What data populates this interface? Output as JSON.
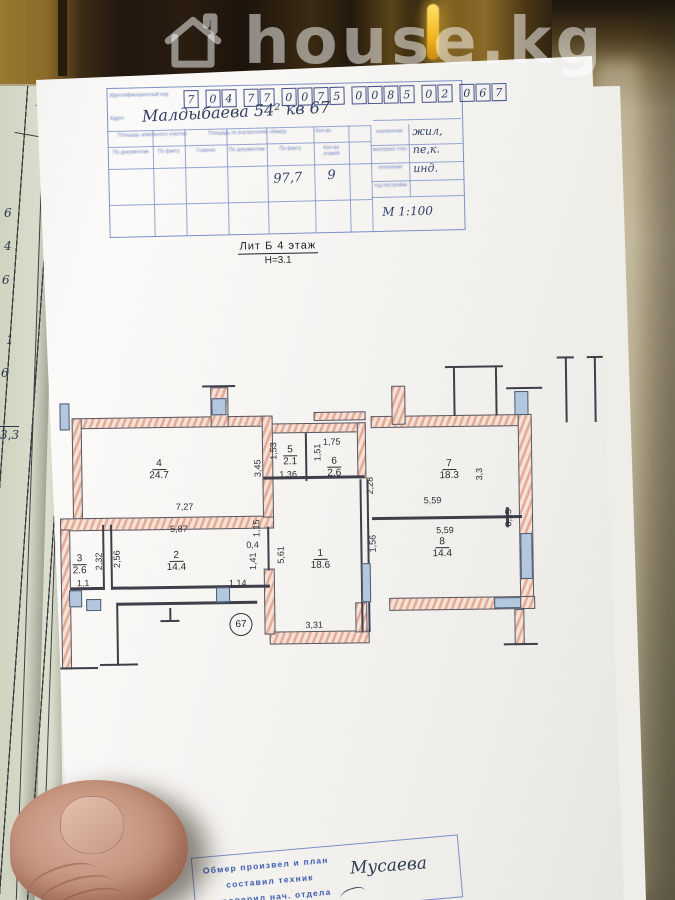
{
  "watermark": {
    "site_name": "house.kg"
  },
  "form": {
    "id_label": "Идентификационный код",
    "id_digits": [
      "7",
      "0",
      "4",
      "7",
      "7",
      "0",
      "0",
      "7",
      "5",
      "0",
      "0",
      "8",
      "5",
      "0",
      "2",
      "0",
      "6",
      "7"
    ],
    "address_label": "Адрес",
    "address_value": "Малдыбаева 54² кв 67",
    "table": {
      "section_headers": [
        "Площадь земельного участка",
        "Площадь по внутреннему обмеру",
        "Кол-во"
      ],
      "col_headers": [
        "По документам",
        "По факту",
        "Главная",
        "По документам",
        "По факту",
        "Кол-во этажей"
      ],
      "total_area_value": "97,7",
      "floors_value": "9",
      "right_rows": [
        {
          "label": "назначение",
          "value": "жил,"
        },
        {
          "label": "материал стен",
          "value": "пе,к."
        },
        {
          "label": "отопление",
          "value": "инд."
        },
        {
          "label": "год постройки",
          "value": ""
        }
      ],
      "scale_value": "М 1:100"
    }
  },
  "title": {
    "liter_floor": "Лит Б 4 этаж",
    "height": "Н=3.1"
  },
  "plan": {
    "apartment_number": "67",
    "rooms": [
      {
        "num": "1",
        "area": "18.6"
      },
      {
        "num": "2",
        "area": "14.4"
      },
      {
        "num": "3",
        "area": "2.6"
      },
      {
        "num": "4",
        "area": "24.7"
      },
      {
        "num": "5",
        "area": "2.1"
      },
      {
        "num": "6",
        "area": "2.6"
      },
      {
        "num": "7",
        "area": "18.3"
      },
      {
        "num": "8",
        "area": "14.4"
      }
    ],
    "dims": {
      "d727": "7,27",
      "d587": "5,87",
      "d345": "3,45",
      "d153": "1,53",
      "d136": "1,36",
      "d175": "1,75",
      "d151": "1,51",
      "d228": "2,28",
      "d33": "3,3",
      "d559a": "5,59",
      "d559b": "5,59",
      "d015": "0,15",
      "d256": "2,56",
      "d232": "2,32",
      "d11": "1,1",
      "d115": "1,15",
      "d04": "0,4",
      "d141": "1,41",
      "d114": "1,14",
      "d561": "5,61",
      "d156": "1,56",
      "d331": "3,31"
    }
  },
  "stamp": {
    "lines": [
      "Обмер произвел и план",
      "составил техник",
      "проверил нач. отдела"
    ]
  },
  "signature": "Мусаева",
  "side_document": {
    "page_label": "№ 1",
    "column_label": "прочие",
    "entries": [
      "6",
      "4",
      "6",
      "1",
      "6",
      "3,3"
    ]
  }
}
